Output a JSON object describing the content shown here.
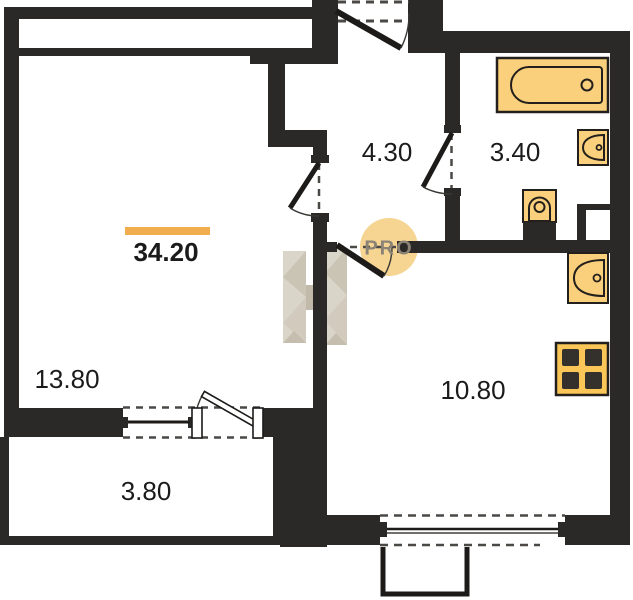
{
  "total_area": {
    "label": "34.20"
  },
  "rooms": {
    "living": {
      "label": "13.80"
    },
    "balcony": {
      "label": "3.80"
    },
    "hallway": {
      "label": "4.30"
    },
    "bathroom": {
      "label": "3.40"
    },
    "kitchen": {
      "label": "10.80"
    }
  },
  "watermark": {
    "label": "PRO"
  },
  "fixtures": [
    "bathtub-icon",
    "bathroom-sink-icon",
    "toilet-icon",
    "kitchen-sink-icon",
    "stove-icon"
  ],
  "colors": {
    "wall": "#2a2927",
    "fixture_fill": "#fbd07c",
    "fixture_stroke": "#221f1c",
    "area_highlight_bar": "#f2ad4f",
    "watermark_circle": "#f6d28c",
    "watermark_text": "#8b8476",
    "watermark_logo": "#d9d3c7"
  }
}
